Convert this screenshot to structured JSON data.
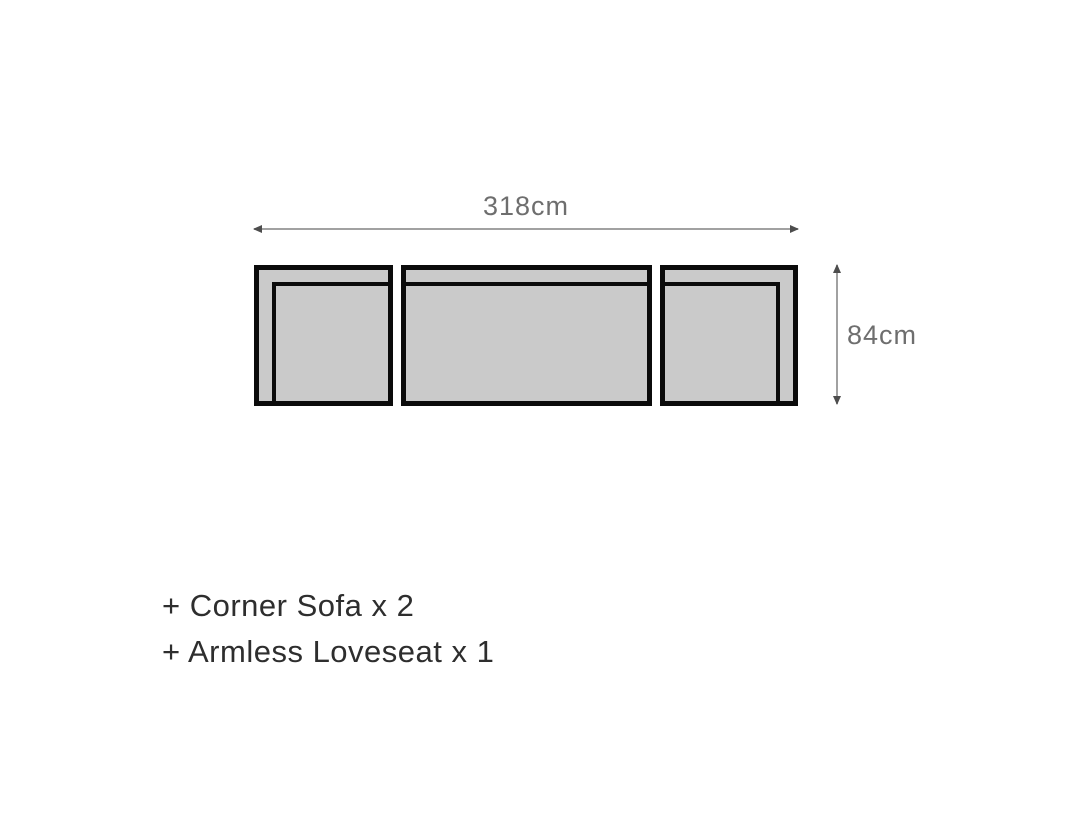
{
  "diagram": {
    "width_label": "318cm",
    "height_label": "84cm",
    "pieces": [
      {
        "name": "corner-sofa-left",
        "arm_side": "left"
      },
      {
        "name": "armless-loveseat",
        "arm_side": "none"
      },
      {
        "name": "corner-sofa-right",
        "arm_side": "right"
      }
    ]
  },
  "includes": {
    "items": [
      "+ Corner Sofa x 2",
      "+ Armless Loveseat x 1"
    ]
  },
  "colors": {
    "background": "#ffffff",
    "sofa-fill": "#cacaca",
    "sofa-outline": "#0b0b0b",
    "dim-line": "#a1a1a1",
    "dim-cap": "#4d4d4d",
    "dim-text": "#6e6e6e",
    "list-text": "#2e2e2e"
  }
}
